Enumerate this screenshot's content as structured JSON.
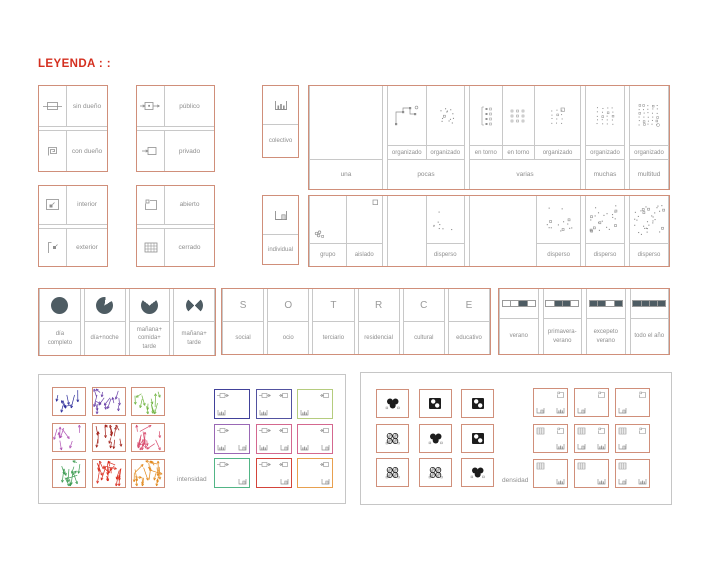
{
  "title": "LEYENDA : :",
  "colors": {
    "frame": "#d08f7a",
    "title_red": "#d42f1f",
    "grid_line": "#c8c8c8",
    "text_gray": "#8f8f8f",
    "dark_fill": "#4e5c63"
  },
  "ownership_grids": [
    {
      "name": "dueno",
      "rows": [
        {
          "icon": "sin-dueno",
          "label": "sin dueño"
        },
        {
          "icon": "con-dueno",
          "label": "con dueño"
        }
      ]
    },
    {
      "name": "acceso",
      "rows": [
        {
          "icon": "publico",
          "label": "público"
        },
        {
          "icon": "privado",
          "label": "privado"
        }
      ]
    },
    {
      "name": "posicion",
      "rows": [
        {
          "icon": "interior",
          "label": "interior"
        },
        {
          "icon": "exterior",
          "label": "exterior"
        }
      ]
    },
    {
      "name": "cerramiento",
      "rows": [
        {
          "icon": "abierto",
          "label": "abierto"
        },
        {
          "icon": "cerrado",
          "label": "cerrado"
        }
      ]
    }
  ],
  "quantity": {
    "collective_label": "colectivo",
    "individual_label": "individual",
    "columns": [
      {
        "label": "una",
        "width": 74,
        "top": [
          {
            "icon": "none",
            "label": ""
          }
        ],
        "bottom": [
          {
            "icon": "grupo",
            "label": "grupo",
            "align": "bl"
          },
          {
            "icon": "aislado",
            "label": "aislado",
            "align": "tr"
          }
        ]
      },
      {
        "label": "pocas",
        "width": 78,
        "top": [
          {
            "icon": "organizado-path",
            "label": "organizado"
          },
          {
            "icon": "organizado-scatter",
            "label": "organizado"
          }
        ],
        "bottom": [
          {
            "icon": "none",
            "label": ""
          },
          {
            "icon": "disperso-sparse",
            "label": "disperso"
          }
        ]
      },
      {
        "label": "varias",
        "width": 112,
        "top": [
          {
            "icon": "en-torno-bracket",
            "label": "en torno",
            "flex": 0.95
          },
          {
            "icon": "en-torno-grid",
            "label": "en torno",
            "flex": 0.95
          },
          {
            "icon": "organizado-grid-sq",
            "label": "organizado",
            "flex": 1.35
          }
        ],
        "bottom": [
          {
            "icon": "none",
            "label": "",
            "flex": 1.55
          },
          {
            "icon": "disperso-medium",
            "label": "disperso",
            "flex": 1
          }
        ]
      },
      {
        "label": "muchas",
        "width": 40,
        "top": [
          {
            "icon": "organizado-grid-2",
            "label": "organizado"
          }
        ],
        "bottom": [
          {
            "icon": "disperso-dense",
            "label": "disperso"
          }
        ]
      },
      {
        "label": "multitud",
        "width": 40,
        "top": [
          {
            "icon": "organizado-grid-3",
            "label": "organizado"
          }
        ],
        "bottom": [
          {
            "icon": "disperso-denser",
            "label": "disperso"
          }
        ]
      }
    ]
  },
  "time_of_day": {
    "cells": [
      {
        "icon": "pie-full",
        "label": "día\ncompleto"
      },
      {
        "icon": "pie-day-night",
        "label": "día+noche"
      },
      {
        "icon": "pie-three-part",
        "label": "mañana+\ncomida+\ntarde"
      },
      {
        "icon": "pie-two-part",
        "label": "mañana+\ntarde"
      }
    ]
  },
  "uses": {
    "cells": [
      {
        "letter": "S",
        "label": "social"
      },
      {
        "letter": "O",
        "label": "ocio"
      },
      {
        "letter": "T",
        "label": "terciario"
      },
      {
        "letter": "R",
        "label": "residencial"
      },
      {
        "letter": "C",
        "label": "cultural"
      },
      {
        "letter": "E",
        "label": "educativo"
      }
    ]
  },
  "seasons": {
    "cells": [
      {
        "pattern": [
          0,
          0,
          1,
          0
        ],
        "label": "verano"
      },
      {
        "pattern": [
          0,
          1,
          1,
          0
        ],
        "label": "primavera-\nverano"
      },
      {
        "pattern": [
          1,
          1,
          0,
          1
        ],
        "label": "excepeto\nverano"
      },
      {
        "pattern": [
          1,
          1,
          1,
          1
        ],
        "label": "todo el año"
      }
    ]
  },
  "intensity": {
    "label": "intensidad",
    "scribbles": [
      {
        "color": "#2d2d9a",
        "density": 8
      },
      {
        "color": "#6b42a8",
        "density": 15
      },
      {
        "color": "#72b544",
        "density": 12
      },
      {
        "color": "#b055b5",
        "density": 8
      },
      {
        "color": "#a3231c",
        "density": 15
      },
      {
        "color": "#d94f70",
        "density": 17
      },
      {
        "color": "#3d9c52",
        "density": 13
      },
      {
        "color": "#d92b1d",
        "density": 20
      },
      {
        "color": "#e2881c",
        "density": 20
      }
    ],
    "combos": [
      {
        "border": "#41419a",
        "tl": "publico",
        "bl": "colectivo"
      },
      {
        "border": "#5252a0",
        "tl": "publico",
        "tr": "privado",
        "bl": "colectivo"
      },
      {
        "border": "#b5cc7e",
        "tr": "privado",
        "bl": "colectivo"
      },
      {
        "border": "#9a68b5",
        "tl": "publico",
        "bl": "colectivo",
        "br": "individual"
      },
      {
        "border": "#d4688f",
        "tl": "publico",
        "tr": "privado",
        "bl": "colectivo",
        "br": "individual"
      },
      {
        "border": "#d4688f",
        "tr": "privado",
        "bl": "colectivo",
        "br": "individual"
      },
      {
        "border": "#52b586",
        "tl": "publico",
        "br": "individual"
      },
      {
        "border": "#d4443a",
        "tl": "publico",
        "tr": "privado",
        "br": "individual"
      },
      {
        "border": "#e8a04f",
        "tr": "privado",
        "br": "individual"
      }
    ]
  },
  "density": {
    "label": "densidad",
    "icons": [
      "cluster-solid",
      "square-holes",
      "square-holes",
      "cluster-pattern",
      "cluster-solid",
      "square-holes",
      "cluster-pattern",
      "cluster-pattern",
      "cluster-solid"
    ],
    "combos": [
      {
        "tr": "abierto",
        "bl": "individual",
        "br": "colectivo"
      },
      {
        "tr": "abierto",
        "bl": "individual"
      },
      {
        "tr": "abierto",
        "bl": "individual"
      },
      {
        "tl": "cerrado",
        "tr": "abierto",
        "br": "colectivo"
      },
      {
        "tl": "cerrado",
        "tr": "abierto",
        "bl": "individual",
        "br": "colectivo"
      },
      {
        "tl": "cerrado",
        "tr": "abierto",
        "bl": "individual"
      },
      {
        "tl": "cerrado",
        "br": "colectivo"
      },
      {
        "tl": "cerrado",
        "br": "colectivo"
      },
      {
        "tl": "cerrado",
        "bl": "individual",
        "br": "colectivo"
      }
    ]
  }
}
